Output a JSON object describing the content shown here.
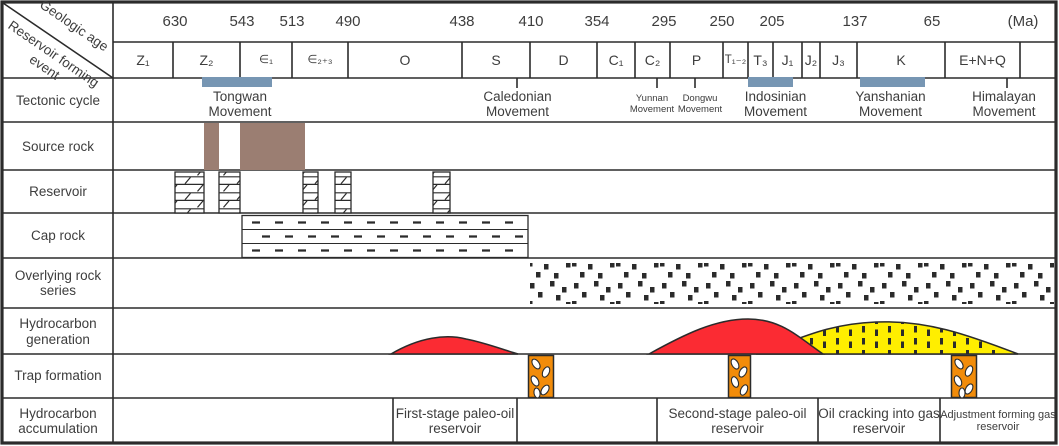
{
  "corner": {
    "top": "Geologic age",
    "bottom": "Reservoir forming event"
  },
  "age_axis": {
    "ticks": [
      "630",
      "543",
      "513",
      "490",
      "438",
      "410",
      "354",
      "295",
      "250",
      "205",
      "137",
      "65"
    ],
    "unit": "(Ma)"
  },
  "periods": [
    "Z₁",
    "Z₂",
    "∈₁",
    "∈₂₊₃",
    "O",
    "S",
    "D",
    "C₁",
    "C₂",
    "P",
    "T₁₋₂",
    "T₃",
    "J₁",
    "J₂",
    "J₃",
    "K",
    "E+N+Q"
  ],
  "row_labels": {
    "tectonic": "Tectonic cycle",
    "source": "Source rock",
    "reservoir": "Reservoir",
    "cap": "Cap rock",
    "overlying": "Overlying rock series",
    "generation": "Hydrocarbon generation",
    "trap": "Trap formation",
    "accumulation": "Hydrocarbon accumulation"
  },
  "movements": {
    "tongwan": "Tongwan Movement",
    "caledonian": "Caledonian Movement",
    "yunnan": "Yunnan Movement",
    "dongwu": "Dongwu Movement",
    "indosinian": "Indosinian Movement",
    "yanshanian": "Yanshanian Movement",
    "himalayan": "Himalayan Movement"
  },
  "accumulation_stages": {
    "first": "First-stage paleo-oil reservoir",
    "second": "Second-stage paleo-oil reservoir",
    "cracking": "Oil cracking into gas reservoir",
    "adjustment": "Adjustment forming gas reservoir"
  },
  "colors": {
    "tectonic_bar": "#7796B3",
    "source_rock": "#9B7E72",
    "oil_generation": "#FB2B33",
    "gas_generation": "#FFEE00",
    "trap_bar": "#F28C0A",
    "line": "#2B2B2B"
  }
}
